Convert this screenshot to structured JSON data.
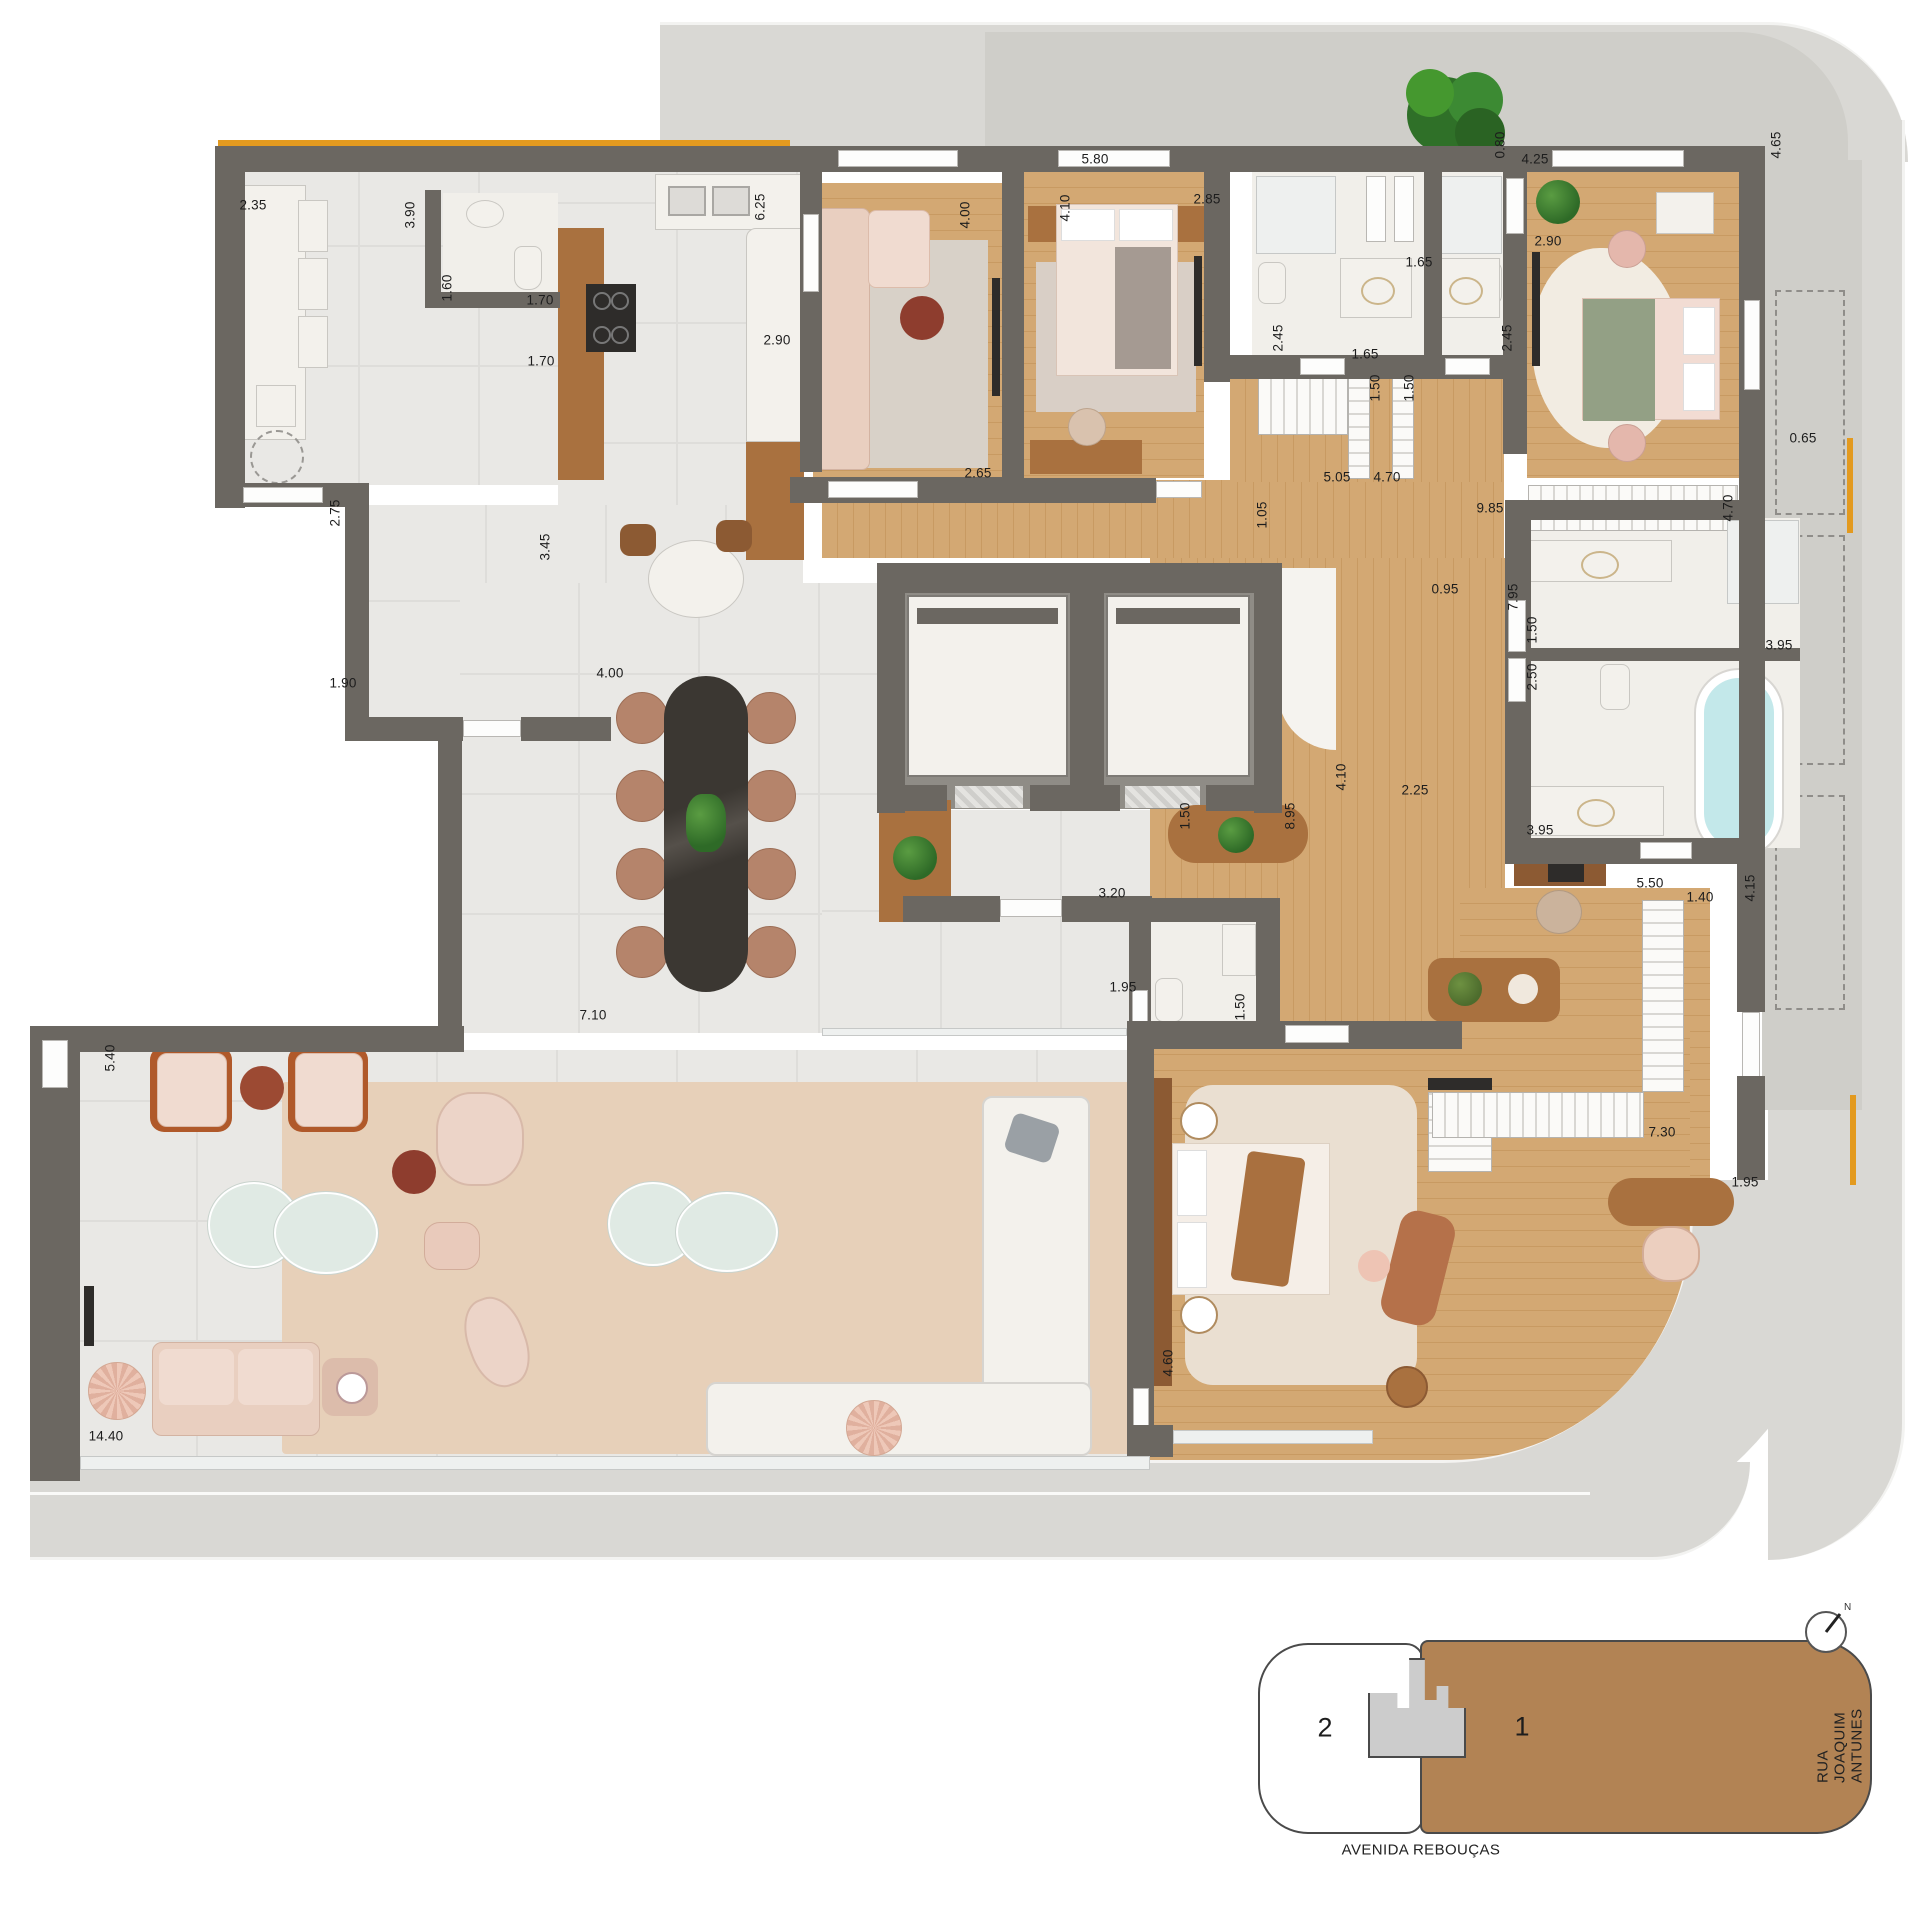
{
  "canvas": {
    "width": 1920,
    "height": 1920
  },
  "colors": {
    "wall": "#6b6761",
    "wood": "#cfa26b",
    "tile": "#e9e8e5",
    "marble": "#f1efea",
    "terrace": "#cfcec9",
    "sidewalk": "#d9d8d4",
    "accent_orange": "#e39a1f",
    "rug_beige": "#e7d0b9",
    "keyplan_unit1_brown": "#b28354",
    "tub_blue": "#c3e8ea"
  },
  "dimensions": [
    {
      "label": "2.35",
      "x": 253,
      "y": 205,
      "rot": 0
    },
    {
      "label": "3.90",
      "x": 410,
      "y": 215,
      "rot": 1
    },
    {
      "label": "1.60",
      "x": 447,
      "y": 288,
      "rot": 1
    },
    {
      "label": "1.70",
      "x": 540,
      "y": 300,
      "rot": 0
    },
    {
      "label": "1.70",
      "x": 541,
      "y": 361,
      "rot": 0
    },
    {
      "label": "6.25",
      "x": 760,
      "y": 207,
      "rot": 1
    },
    {
      "label": "2.90",
      "x": 777,
      "y": 340,
      "rot": 0
    },
    {
      "label": "4.00",
      "x": 965,
      "y": 215,
      "rot": 1
    },
    {
      "label": "2.65",
      "x": 978,
      "y": 473,
      "rot": 0
    },
    {
      "label": "5.80",
      "x": 1095,
      "y": 159,
      "rot": 0
    },
    {
      "label": "4.10",
      "x": 1065,
      "y": 208,
      "rot": 1
    },
    {
      "label": "2.85",
      "x": 1207,
      "y": 199,
      "rot": 0
    },
    {
      "label": "1.65",
      "x": 1419,
      "y": 262,
      "rot": 0
    },
    {
      "label": "2.45",
      "x": 1278,
      "y": 338,
      "rot": 1
    },
    {
      "label": "1.65",
      "x": 1365,
      "y": 354,
      "rot": 0
    },
    {
      "label": "2.45",
      "x": 1507,
      "y": 338,
      "rot": 1
    },
    {
      "label": "1.50",
      "x": 1375,
      "y": 388,
      "rot": 1
    },
    {
      "label": "1.50",
      "x": 1409,
      "y": 388,
      "rot": 1
    },
    {
      "label": "5.05",
      "x": 1337,
      "y": 477,
      "rot": 0
    },
    {
      "label": "4.70",
      "x": 1387,
      "y": 477,
      "rot": 0
    },
    {
      "label": "0.80",
      "x": 1500,
      "y": 145,
      "rot": 1
    },
    {
      "label": "4.25",
      "x": 1535,
      "y": 159,
      "rot": 0
    },
    {
      "label": "2.90",
      "x": 1548,
      "y": 241,
      "rot": 0
    },
    {
      "label": "4.65",
      "x": 1776,
      "y": 145,
      "rot": 1
    },
    {
      "label": "0.65",
      "x": 1803,
      "y": 438,
      "rot": 0
    },
    {
      "label": "1.05",
      "x": 1262,
      "y": 515,
      "rot": 1
    },
    {
      "label": "9.85",
      "x": 1490,
      "y": 508,
      "rot": 0
    },
    {
      "label": "4.70",
      "x": 1728,
      "y": 508,
      "rot": 1
    },
    {
      "label": "0.95",
      "x": 1445,
      "y": 589,
      "rot": 0
    },
    {
      "label": "7.95",
      "x": 1513,
      "y": 597,
      "rot": 1
    },
    {
      "label": "1.50",
      "x": 1532,
      "y": 630,
      "rot": 1
    },
    {
      "label": "2.50",
      "x": 1532,
      "y": 677,
      "rot": 1
    },
    {
      "label": "3.95",
      "x": 1779,
      "y": 645,
      "rot": 0
    },
    {
      "label": "3.95",
      "x": 1540,
      "y": 830,
      "rot": 0
    },
    {
      "label": "2.25",
      "x": 1415,
      "y": 790,
      "rot": 0
    },
    {
      "label": "4.10",
      "x": 1341,
      "y": 777,
      "rot": 1
    },
    {
      "label": "8.95",
      "x": 1290,
      "y": 816,
      "rot": 1
    },
    {
      "label": "1.50",
      "x": 1185,
      "y": 816,
      "rot": 1
    },
    {
      "label": "3.20",
      "x": 1112,
      "y": 893,
      "rot": 0
    },
    {
      "label": "5.50",
      "x": 1650,
      "y": 883,
      "rot": 0
    },
    {
      "label": "1.40",
      "x": 1700,
      "y": 897,
      "rot": 0
    },
    {
      "label": "4.15",
      "x": 1750,
      "y": 888,
      "rot": 1
    },
    {
      "label": "1.95",
      "x": 1123,
      "y": 987,
      "rot": 0
    },
    {
      "label": "1.50",
      "x": 1240,
      "y": 1007,
      "rot": 1
    },
    {
      "label": "7.10",
      "x": 593,
      "y": 1015,
      "rot": 0
    },
    {
      "label": "2.75",
      "x": 335,
      "y": 513,
      "rot": 1
    },
    {
      "label": "3.45",
      "x": 545,
      "y": 547,
      "rot": 1
    },
    {
      "label": "1.90",
      "x": 343,
      "y": 683,
      "rot": 0
    },
    {
      "label": "4.00",
      "x": 610,
      "y": 673,
      "rot": 0
    },
    {
      "label": "5.40",
      "x": 110,
      "y": 1058,
      "rot": 1
    },
    {
      "label": "14.40",
      "x": 106,
      "y": 1436,
      "rot": 0
    },
    {
      "label": "7.30",
      "x": 1662,
      "y": 1132,
      "rot": 0
    },
    {
      "label": "1.95",
      "x": 1745,
      "y": 1182,
      "rot": 0
    },
    {
      "label": "4.60",
      "x": 1168,
      "y": 1363,
      "rot": 1
    }
  ],
  "keyplan": {
    "unit_1_label": "1",
    "unit_2_label": "2",
    "street_bottom": "AVENIDA REBOUÇAS",
    "street_right": "RUA JOAQUIM ANTUNES",
    "north_label": "N"
  }
}
